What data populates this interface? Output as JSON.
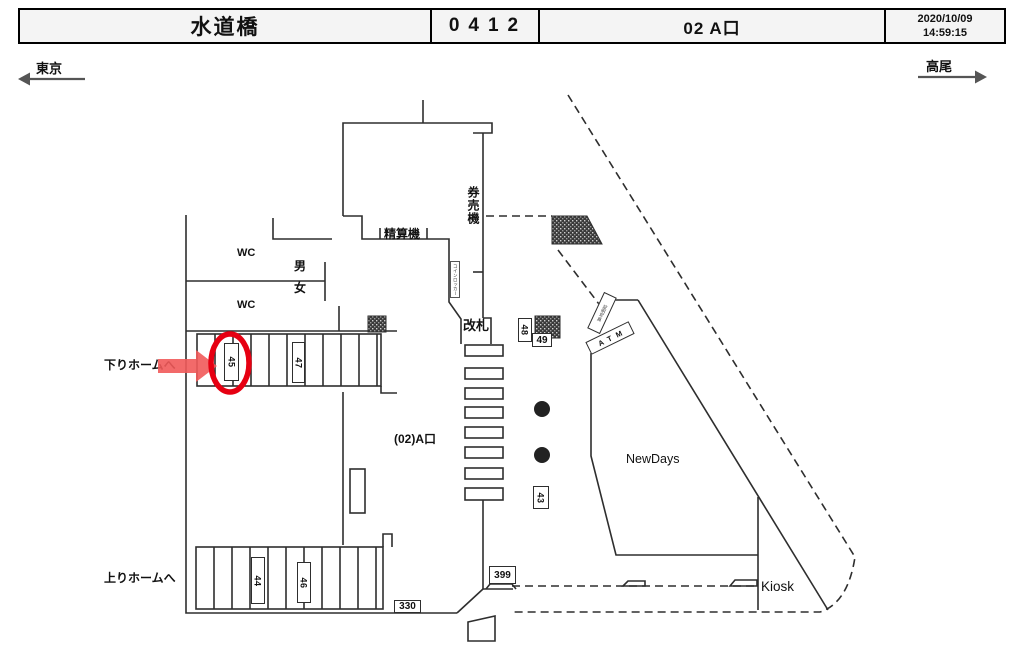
{
  "header": {
    "station": "水道橋",
    "code": "0412",
    "location": "02 A口",
    "date": "2020/10/09",
    "time": "14:59:15"
  },
  "compass": {
    "left": "東京",
    "right": "高尾"
  },
  "plan": {
    "to_down_platform": "下りホームへ",
    "to_up_platform": "上りホームへ",
    "wc_top": "WC",
    "wc_bottom": "WC",
    "men": "男",
    "women": "女",
    "fare_adjustment": "精算機",
    "ticket_machines": "券売機",
    "coin_locker": "コインロッカー",
    "gate": "改札",
    "exit_name": "(02)A口",
    "photo_booth": "証明写真",
    "atm": "ATM",
    "newdays": "NewDays",
    "kiosk": "Kiosk",
    "num_43": "43",
    "num_44": "44",
    "num_45": "45",
    "num_46": "46",
    "num_47": "47",
    "num_48": "48",
    "num_49": "49",
    "num_330": "330",
    "num_399": "399"
  },
  "highlight": {
    "target": "45"
  },
  "colors": {
    "line": "#2e2e2e",
    "highlight_red": "#e60012",
    "arrow_red": "#f15a5a",
    "compass": "#555555"
  }
}
